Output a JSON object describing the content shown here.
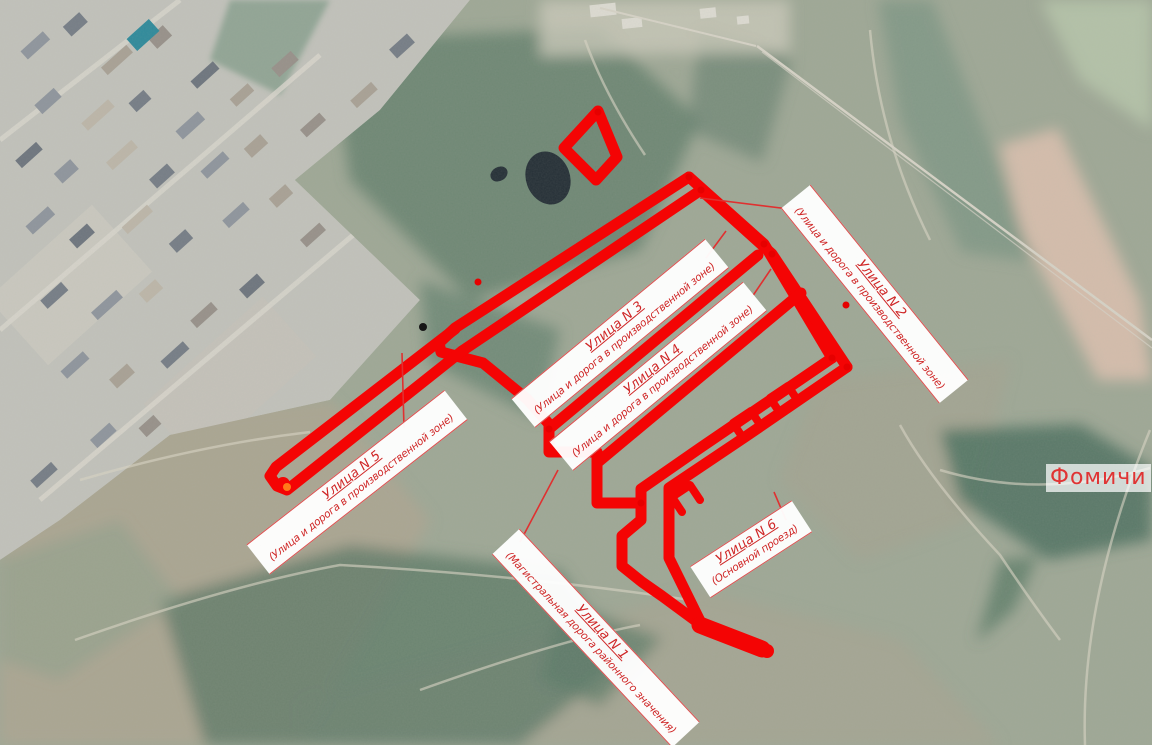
{
  "map": {
    "place_label": "Фомичи",
    "street_labels": [
      {
        "id": "n3",
        "title": "Улица N 3",
        "desc": "(Улица и дорога в производственной зоне)"
      },
      {
        "id": "n4",
        "title": "Улица N 4",
        "desc": "(Улица и дорога в производственной зоне)"
      },
      {
        "id": "n2",
        "title": "Улица N 2",
        "desc": "(Улица и дорога в производственной зоне)"
      },
      {
        "id": "n5",
        "title": "Улица N 5",
        "desc": "(Улица и дорога в производственной зоне)"
      },
      {
        "id": "n1",
        "title": "Улица N 1",
        "desc": "(Магистральная дорога районного значения)"
      },
      {
        "id": "n6",
        "title": "Улица N 6",
        "desc": "(Основной проезд)"
      }
    ],
    "colors": {
      "road_red": "#f40404",
      "label_red": "#cf2626",
      "banner_bg": "#ffffff",
      "place_red": "#e03434"
    }
  }
}
